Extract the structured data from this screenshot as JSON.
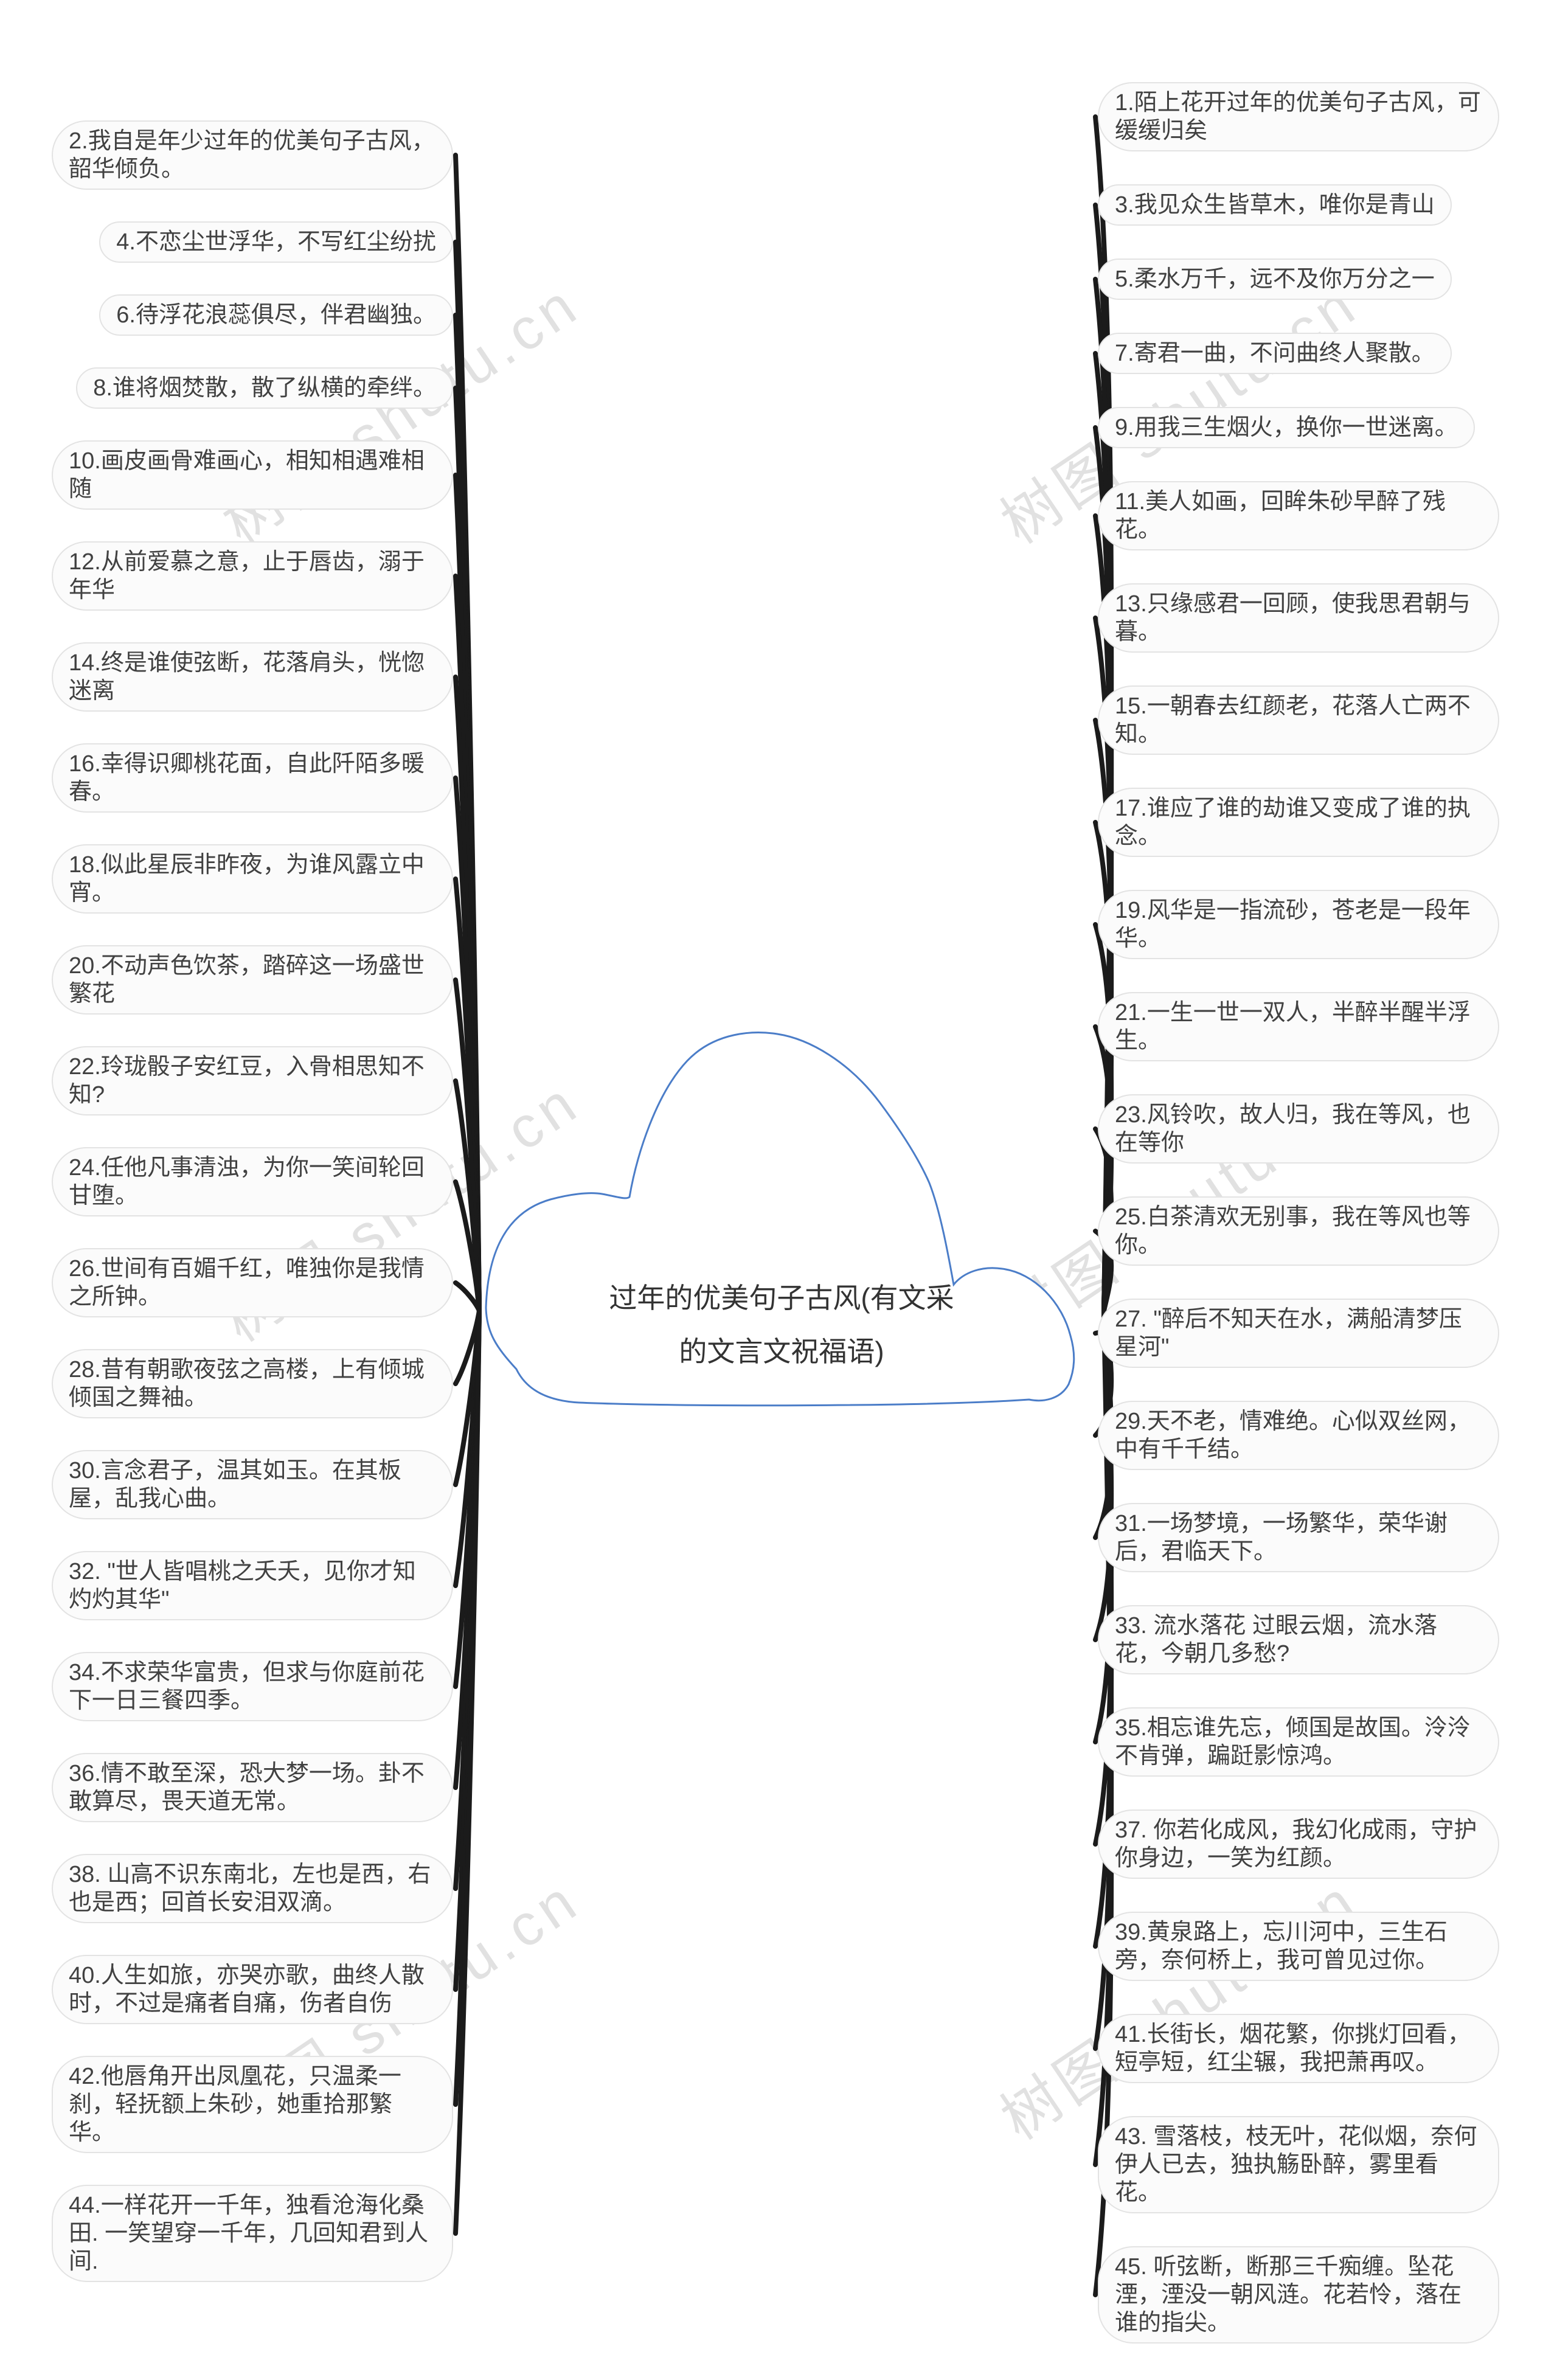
{
  "title": {
    "text": "过年的优美句子古风(有文采的文言文祝福语)"
  },
  "watermark": {
    "text": "树图 shutu.cn",
    "color": "#c9c9c9"
  },
  "colors": {
    "background": "#ffffff",
    "node_fill": "#fbfbfb",
    "node_border": "#e3e3e3",
    "node_text": "#414141",
    "branch": "#1b1b1b",
    "cloud_outline": "#4b7dc8",
    "title_text": "#333333"
  },
  "nodes": {
    "left": [
      {
        "label": "2.我自是年少过年的优美句子古风，韶华倾负。"
      },
      {
        "label": "4.不恋尘世浮华，不写红尘纷扰"
      },
      {
        "label": "6.待浮花浪蕊俱尽，伴君幽独。"
      },
      {
        "label": "8.谁将烟焚散，散了纵横的牵绊。"
      },
      {
        "label": "10.画皮画骨难画心，相知相遇难相随"
      },
      {
        "label": "12.从前爱慕之意，止于唇齿，溺于年华"
      },
      {
        "label": "14.终是谁使弦断，花落肩头，恍惚迷离"
      },
      {
        "label": "16.幸得识卿桃花面，自此阡陌多暖春。"
      },
      {
        "label": "18.似此星辰非昨夜，为谁风露立中宵。"
      },
      {
        "label": "20.不动声色饮茶，踏碎这一场盛世繁花"
      },
      {
        "label": "22.玲珑骰子安红豆，入骨相思知不知?"
      },
      {
        "label": "24.任他凡事清浊，为你一笑间轮回甘堕。"
      },
      {
        "label": "26.世间有百媚千红，唯独你是我情之所钟。"
      },
      {
        "label": "28.昔有朝歌夜弦之高楼，上有倾城倾国之舞袖。"
      },
      {
        "label": "30.言念君子，温其如玉。在其板屋，乱我心曲。"
      },
      {
        "label": "32. \"世人皆唱桃之夭夭，见你才知灼灼其华\""
      },
      {
        "label": "34.不求荣华富贵，但求与你庭前花下一日三餐四季。"
      },
      {
        "label": "36.情不敢至深，恐大梦一场。卦不敢算尽，畏天道无常。"
      },
      {
        "label": "38. 山高不识东南北，左也是西，右也是西；回首长安泪双滴。"
      },
      {
        "label": "40.人生如旅，亦哭亦歌，曲终人散时，不过是痛者自痛，伤者自伤"
      },
      {
        "label": "42.他唇角开出凤凰花，只温柔一刹，轻抚额上朱砂，她重拾那繁华。"
      },
      {
        "label": "44.一样花开一千年，独看沧海化桑田. 一笑望穿一千年，几回知君到人间."
      }
    ],
    "right": [
      {
        "label": "1.陌上花开过年的优美句子古风，可缓缓归矣"
      },
      {
        "label": "3.我见众生皆草木，唯你是青山"
      },
      {
        "label": "5.柔水万千，远不及你万分之一"
      },
      {
        "label": "7.寄君一曲，不问曲终人聚散。"
      },
      {
        "label": "9.用我三生烟火，换你一世迷离。"
      },
      {
        "label": "11.美人如画，回眸朱砂早醉了残花。"
      },
      {
        "label": "13.只缘感君一回顾，使我思君朝与暮。"
      },
      {
        "label": "15.一朝春去红颜老，花落人亡两不知。"
      },
      {
        "label": "17.谁应了谁的劫谁又变成了谁的执念。"
      },
      {
        "label": "19.风华是一指流砂，苍老是一段年华。"
      },
      {
        "label": "21.一生一世一双人，半醉半醒半浮生。"
      },
      {
        "label": "23.风铃吹，故人归，我在等风，也在等你"
      },
      {
        "label": "25.白茶清欢无别事，我在等风也等你。"
      },
      {
        "label": "27. \"醉后不知天在水，满船清梦压星河\""
      },
      {
        "label": "29.天不老，情难绝。心似双丝网，中有千千结。"
      },
      {
        "label": "31.一场梦境，一场繁华，荣华谢后，君临天下。"
      },
      {
        "label": "33. 流水落花 过眼云烟，流水落花，今朝几多愁?"
      },
      {
        "label": "35.相忘谁先忘，倾国是故国。泠泠不肯弹，蹁跹影惊鸿。"
      },
      {
        "label": "37. 你若化成风，我幻化成雨，守护你身边，一笑为红颜。"
      },
      {
        "label": "39.黄泉路上，忘川河中，三生石旁，奈何桥上，我可曾见过你。"
      },
      {
        "label": "41.长街长，烟花繁，你挑灯回看，短亭短，红尘辗，我把萧再叹。"
      },
      {
        "label": "43. 雪落枝，枝无叶，花似烟，奈何伊人已去，独执觞卧醉，雾里看花。"
      },
      {
        "label": "45. 听弦断，断那三千痴缠。坠花湮，湮没一朝风涟。花若怜，落在谁的指尖。"
      }
    ]
  }
}
